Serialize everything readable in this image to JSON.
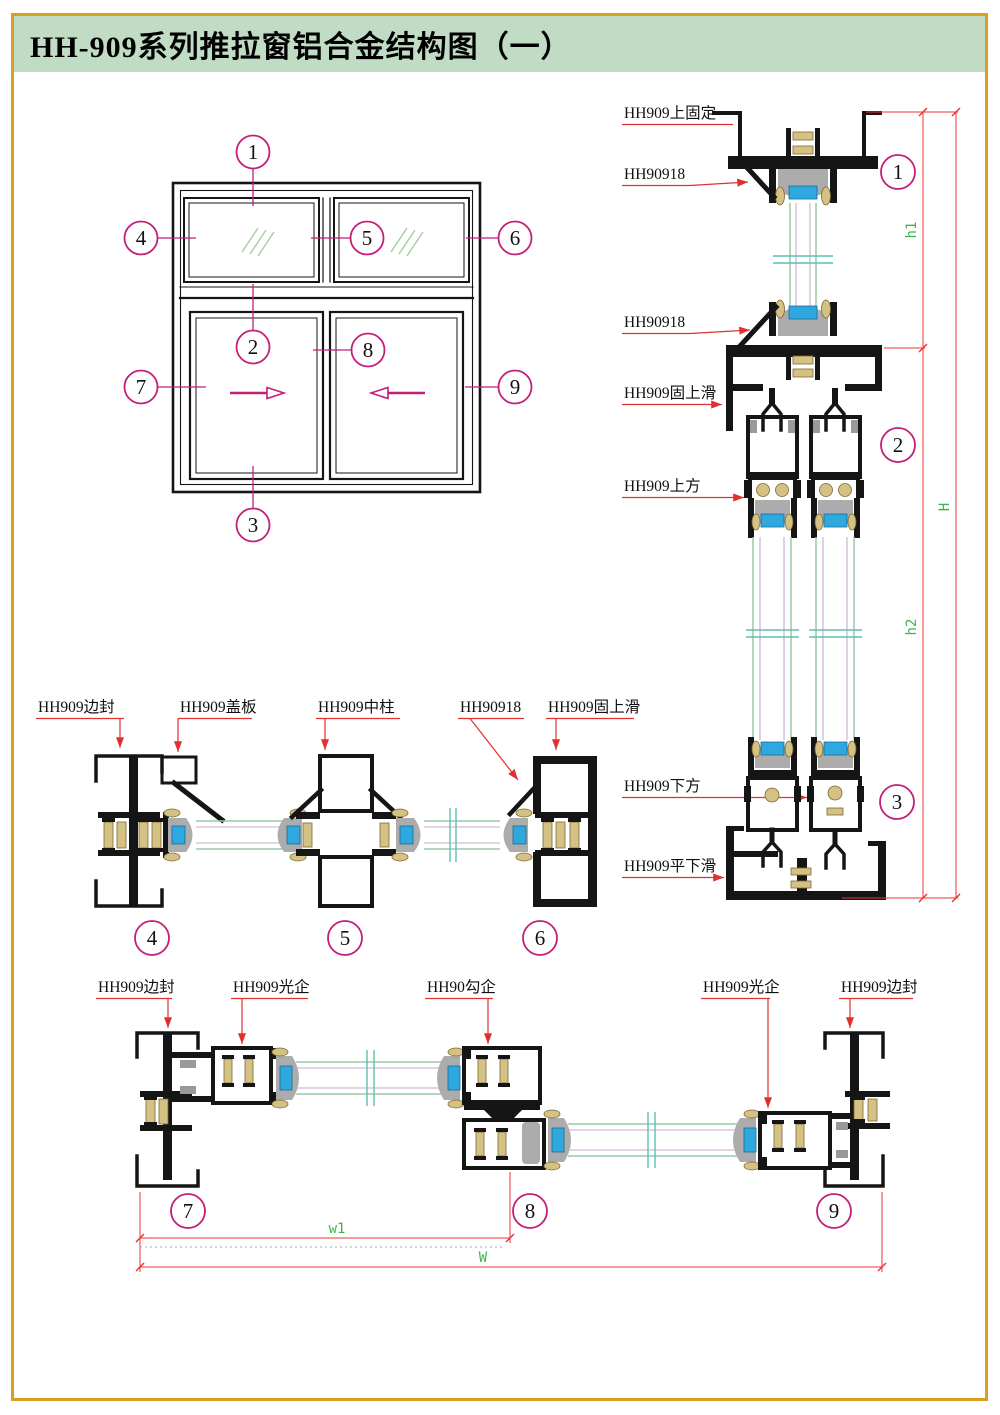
{
  "title": "HH-909系列推拉窗铝合金结构图（一）",
  "colors": {
    "border_gold": "#D8A01D",
    "title_band_green": "#C0DCC5",
    "leader_red": "#E03030",
    "dimension_red": "#EE3333",
    "callout_magenta": "#C31E78",
    "dim_text_green": "#3CB54A",
    "profile_black": "#151515",
    "glass_line_green": "#98C9A8",
    "glass_line_purple": "#C9A9CD",
    "break_line_teal": "#5BC0B4",
    "spacer_blue": "#2FA8E0",
    "gasket_tan": "#D5C183",
    "shade_gray": "#ACACAC"
  },
  "elevation": {
    "callouts": [
      "1",
      "2",
      "3",
      "4",
      "5",
      "6",
      "7",
      "8",
      "9"
    ]
  },
  "right_section": {
    "labels": [
      "HH909上固定",
      "HH90918",
      "HH90918",
      "HH909固上滑",
      "HH909上方",
      "HH909下方",
      "HH909平下滑"
    ],
    "callouts": [
      "1",
      "2",
      "3"
    ],
    "dims": [
      "h1",
      "h2",
      "H"
    ]
  },
  "middle_section": {
    "labels": [
      "HH909边封",
      "HH909盖板",
      "HH909中柱",
      "HH90918",
      "HH909固上滑"
    ],
    "callouts": [
      "4",
      "5",
      "6"
    ]
  },
  "bottom_section": {
    "labels": [
      "HH909边封",
      "HH909光企",
      "HH90勾企",
      "HH909光企",
      "HH909边封"
    ],
    "callouts": [
      "7",
      "8",
      "9"
    ],
    "dims": [
      "w1",
      "W"
    ]
  }
}
